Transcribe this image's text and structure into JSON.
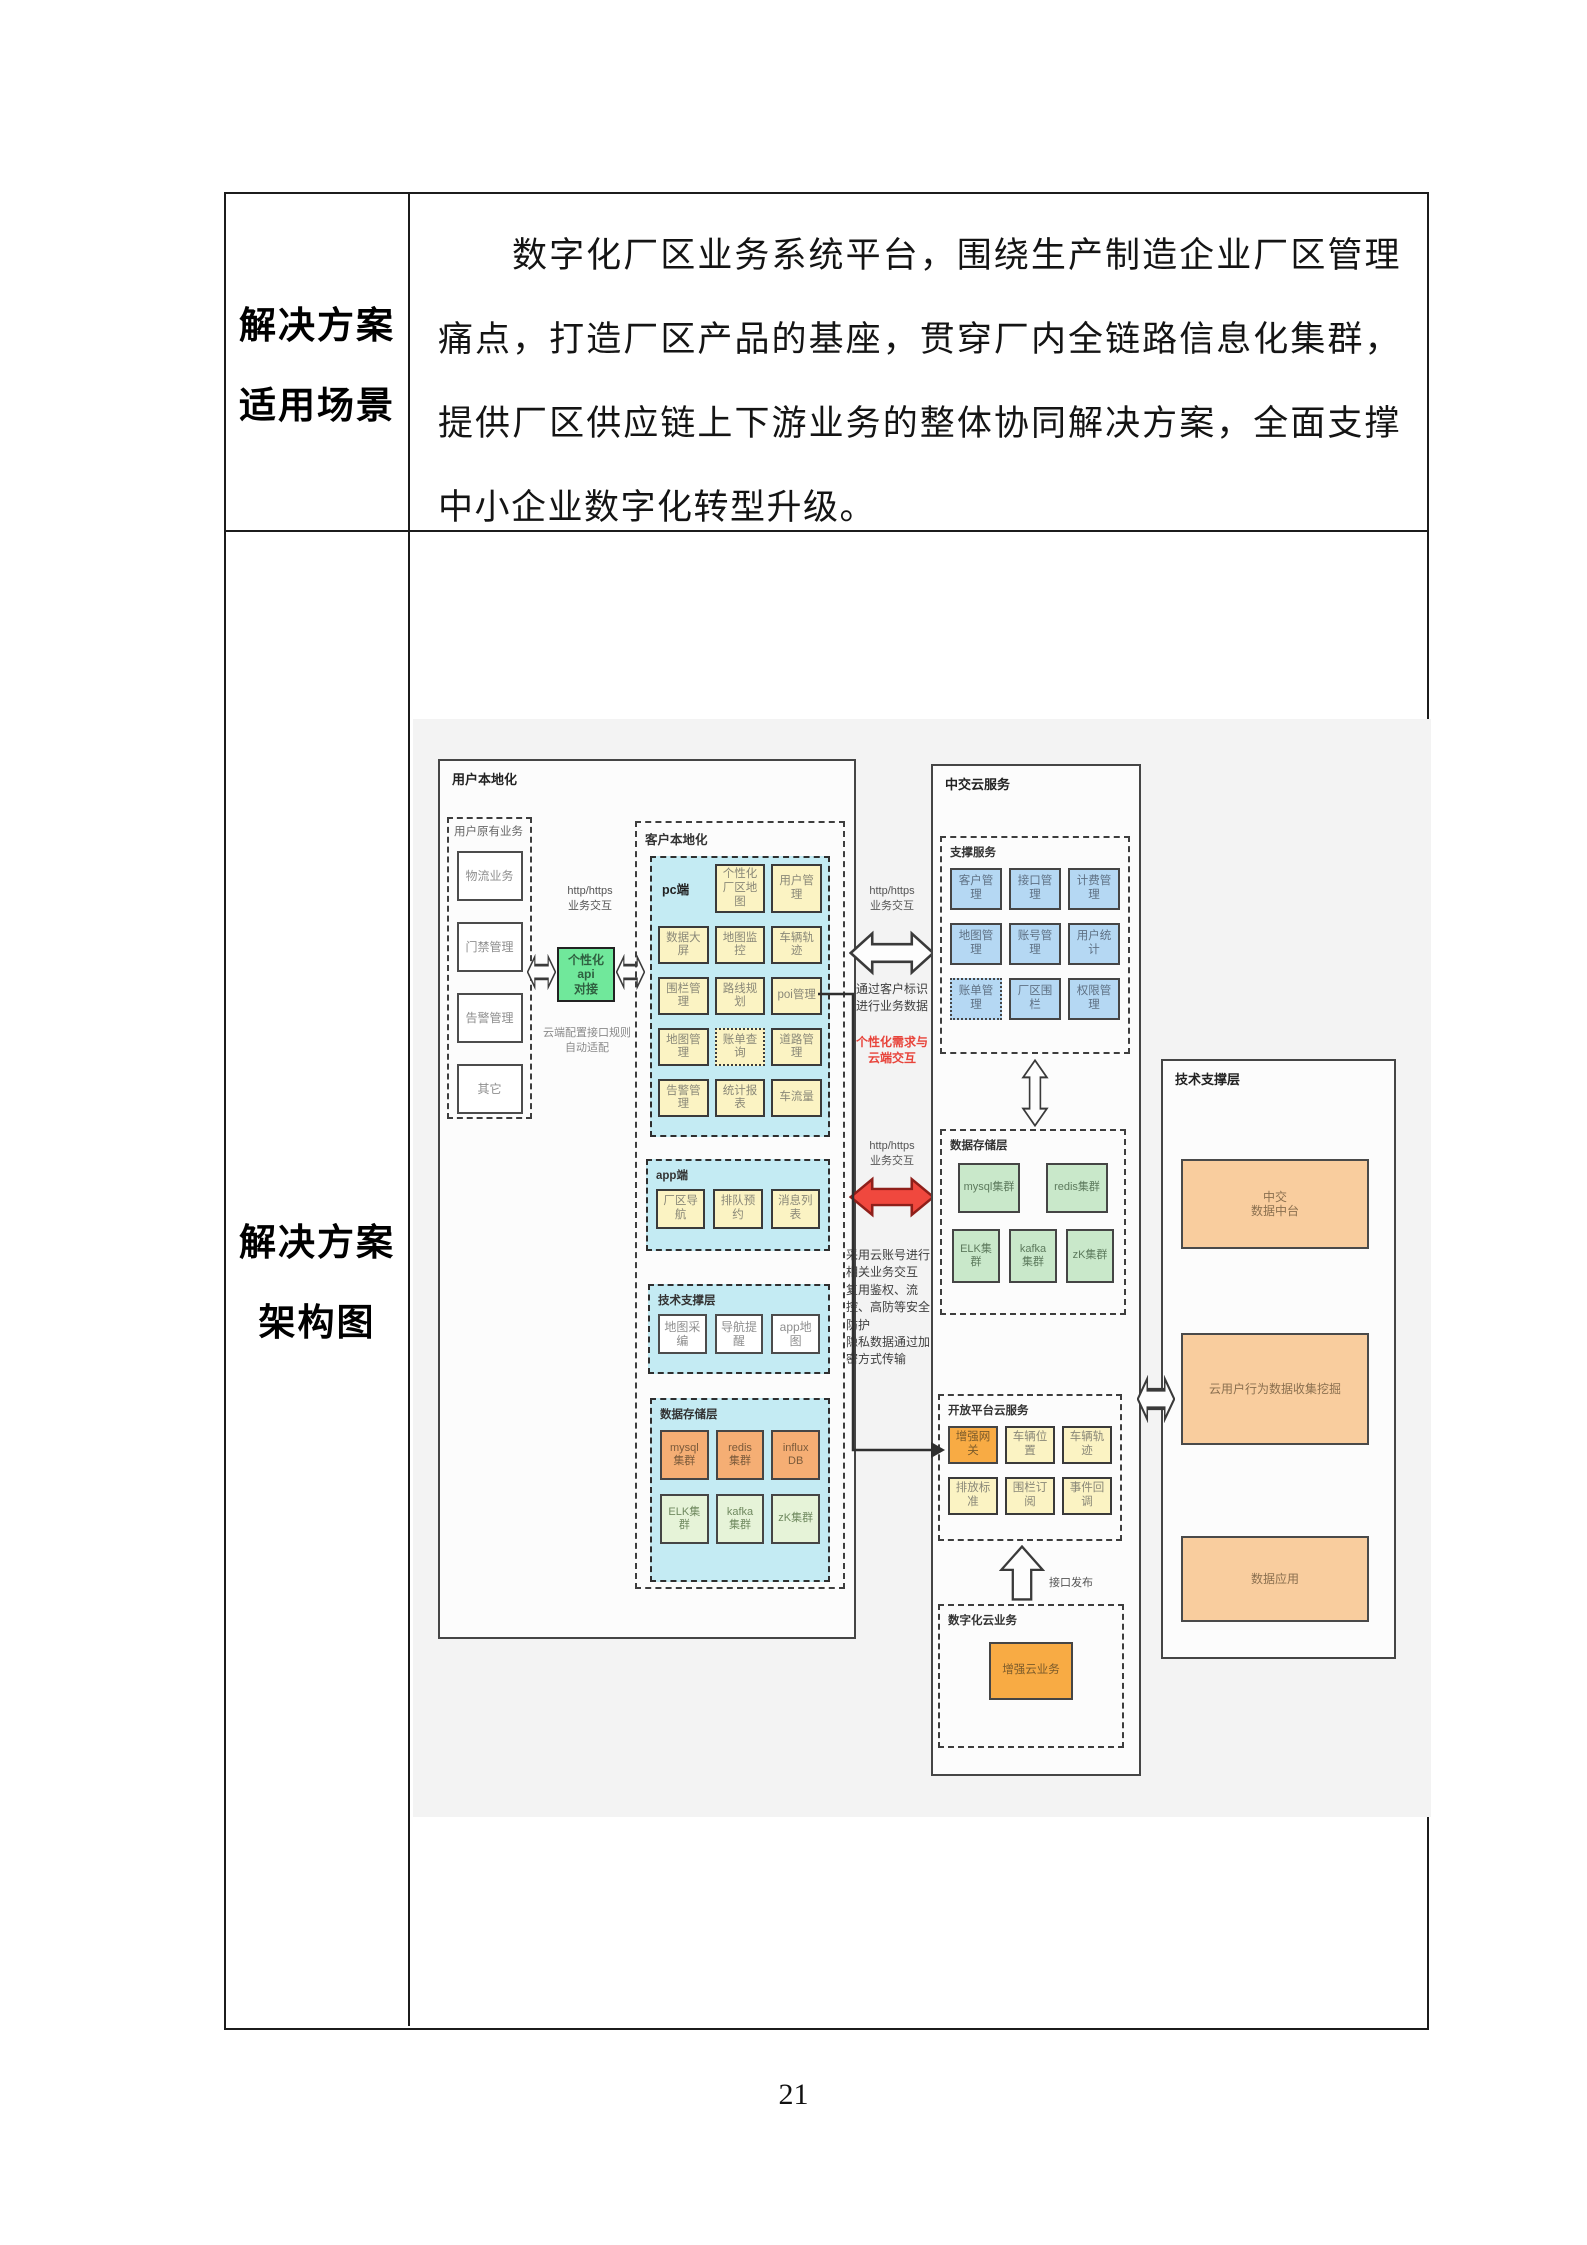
{
  "page": {
    "number": "21"
  },
  "colors": {
    "yellow_box": "#fbf3c3",
    "cyan_section": "#c4ebf3",
    "blue_box": "#b5d8f3",
    "green_box": "#c9e8ca",
    "light_green_box": "#e6f3d8",
    "orange_box": "#f5ae74",
    "bright_orange_box": "#f8ab44",
    "peach_box": "#f9cd9e",
    "api_green_box": "#70e89b",
    "red_accent": "#e8433a",
    "diagram_background": "#f3f3f3"
  },
  "table": {
    "row1": {
      "label_lines": [
        "解决方案",
        "适用场景"
      ],
      "paragraph": "数字化厂区业务系统平台，围绕生产制造企业厂区管理痛点，打造厂区产品的基座，贯穿厂内全链路信息化集群，提供厂区供应链上下游业务的整体协同解决方案，全面支撑中小企业数字化转型升级。"
    },
    "row2": {
      "label_lines": [
        "解决方案",
        "架构图"
      ]
    }
  },
  "diagram": {
    "user_local": {
      "title": "用户本地化",
      "legacy": {
        "title": "用户原有业务",
        "items": [
          "物流业务",
          "门禁管理",
          "告警管理",
          "其它"
        ]
      },
      "api_note_top": "http/https\n业务交互",
      "api_box": "个性化api\n对接",
      "api_note_bottom": "云端配置接口规则\n自动适配",
      "client_local": {
        "title": "客户本地化",
        "pc": {
          "title": "pc端",
          "items": [
            "个性化厂区地图",
            "用户管理",
            "数据大屏",
            "地图监控",
            "车辆轨迹",
            "围栏管理",
            "路线规划",
            "poi管理",
            "地图管理",
            "账单查询",
            "道路管理",
            "告警管理",
            "统计报表",
            "车流量"
          ]
        },
        "app": {
          "title": "app端",
          "items": [
            "厂区导航",
            "排队预约",
            "消息列表"
          ]
        },
        "tech": {
          "title": "技术支撑层",
          "items": [
            "地图采编",
            "导航提醒",
            "app地图"
          ]
        },
        "storage": {
          "title": "数据存储层",
          "items": [
            "mysql\n集群",
            "redis\n集群",
            "influx\nDB",
            "ELK集\n群",
            "kafka\n集群",
            "zK集群"
          ]
        }
      }
    },
    "middle": {
      "note_top": "http/https\n业务交互",
      "caption_top": "通过客户标识\n进行业务数据",
      "red_caption": "个性化需求与\n云端交互",
      "note_bottom": "http/https\n业务交互",
      "caption_bottom": "采用云账号进行\n相关业务交互\n复用鉴权、流\n控、高防等安全\n防护\n隐私数据通过加\n密方式传输"
    },
    "cloud": {
      "title": "中交云服务",
      "support": {
        "title": "支撑服务",
        "items": [
          "客户管理",
          "接口管理",
          "计费管理",
          "地图管理",
          "账号管理",
          "用户统计",
          "账单管理",
          "厂区围栏",
          "权限管理"
        ]
      },
      "storage": {
        "title": "数据存储层",
        "items": [
          "mysql集群",
          "redis集群",
          "ELK集\n群",
          "kafka\n集群",
          "zK集群"
        ]
      },
      "open": {
        "title": "开放平台云服务",
        "items": [
          "增强网关",
          "车辆位置",
          "车辆轨迹",
          "排放标准",
          "围栏订阅",
          "事件回调"
        ]
      },
      "publish_label": "接口发布",
      "digital": {
        "title": "数字化云业务",
        "item": "增强云业务"
      }
    },
    "tech_support": {
      "title": "技术支撑层",
      "items": [
        "中交\n数据中台",
        "云用户行为数据收集挖掘",
        "数据应用"
      ]
    }
  }
}
